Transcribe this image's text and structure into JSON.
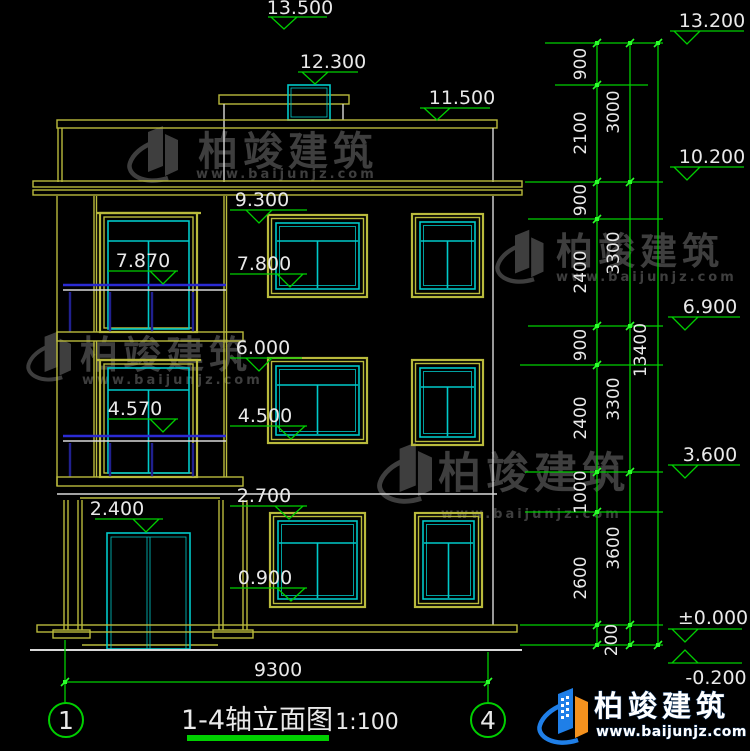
{
  "title_block": {
    "title": "1-4轴立面图",
    "scale": "1:100"
  },
  "axes": {
    "left": "1",
    "right": "4"
  },
  "levels": {
    "top": [
      "13.500",
      "12.300",
      "11.500"
    ],
    "facade": [
      "9.300",
      "7.800",
      "6.000",
      "4.500",
      "2.700",
      "0.900"
    ],
    "inner": [
      "7.870",
      "4.570",
      "2.400"
    ],
    "right": [
      "13.200",
      "10.200",
      "6.900",
      "3.600",
      "±0.000",
      "-0.200"
    ]
  },
  "dims": {
    "col_inner": [
      "900",
      "2100",
      "900",
      "2400",
      "900",
      "2400",
      "1000",
      "2600"
    ],
    "col_mid": [
      "3000",
      "3300",
      "3300",
      "3600"
    ],
    "plinth": "200",
    "col_outer": "13400",
    "bottom": "9300"
  },
  "watermark": {
    "brand": "柏竣建筑",
    "url": "www.baijunjz.com"
  },
  "logo": {
    "brand": "柏竣建筑",
    "url": "www.baijunjz.com"
  },
  "colors": {
    "wall_yellow": "#b9ba3c",
    "frame_cyan": "#00c9c9",
    "dim_green": "#00cf00",
    "line_white": "#d9d9d9",
    "rail_blue": "#2b2bd4",
    "logo_blue": "#1f7fe8",
    "logo_orange": "#f5921e"
  }
}
